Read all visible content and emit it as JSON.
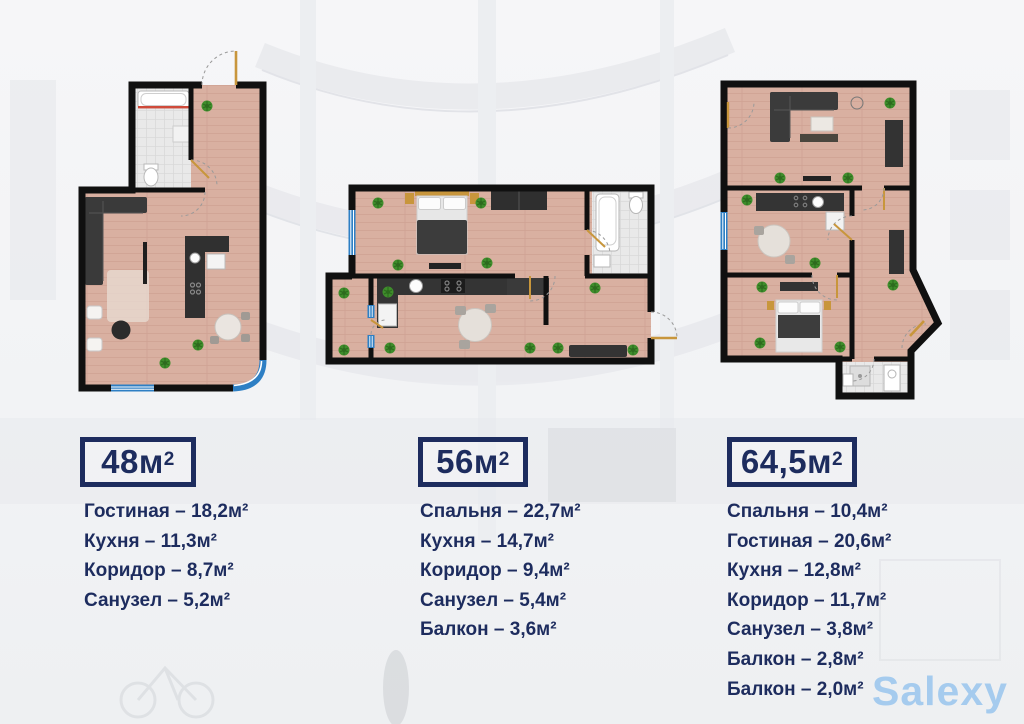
{
  "brand": {
    "logo_text": "Salexy",
    "logo_color": "#a5cbee"
  },
  "accent_color": "#1d2c5e",
  "plans": [
    {
      "area": "48м",
      "area_sup": "2",
      "rooms": [
        "Гостиная – 18,2м²",
        "Кухня – 11,3м²",
        "Коридор – 8,7м²",
        "Санузел – 5,2м²"
      ]
    },
    {
      "area": "56м",
      "area_sup": "2",
      "rooms": [
        "Спальня – 22,7м²",
        "Кухня – 14,7м²",
        "Коридор – 9,4м²",
        "Санузел – 5,4м²",
        "Балкон – 3,6м²"
      ]
    },
    {
      "area": "64,5м",
      "area_sup": "2",
      "rooms": [
        "Спальня – 10,4м²",
        "Гостиная – 20,6м²",
        "Кухня – 12,8м²",
        "Коридор – 11,7м²",
        "Санузел – 3,8м²",
        "Балкон – 2,8м²",
        "Балкон – 2,0м²"
      ]
    }
  ]
}
